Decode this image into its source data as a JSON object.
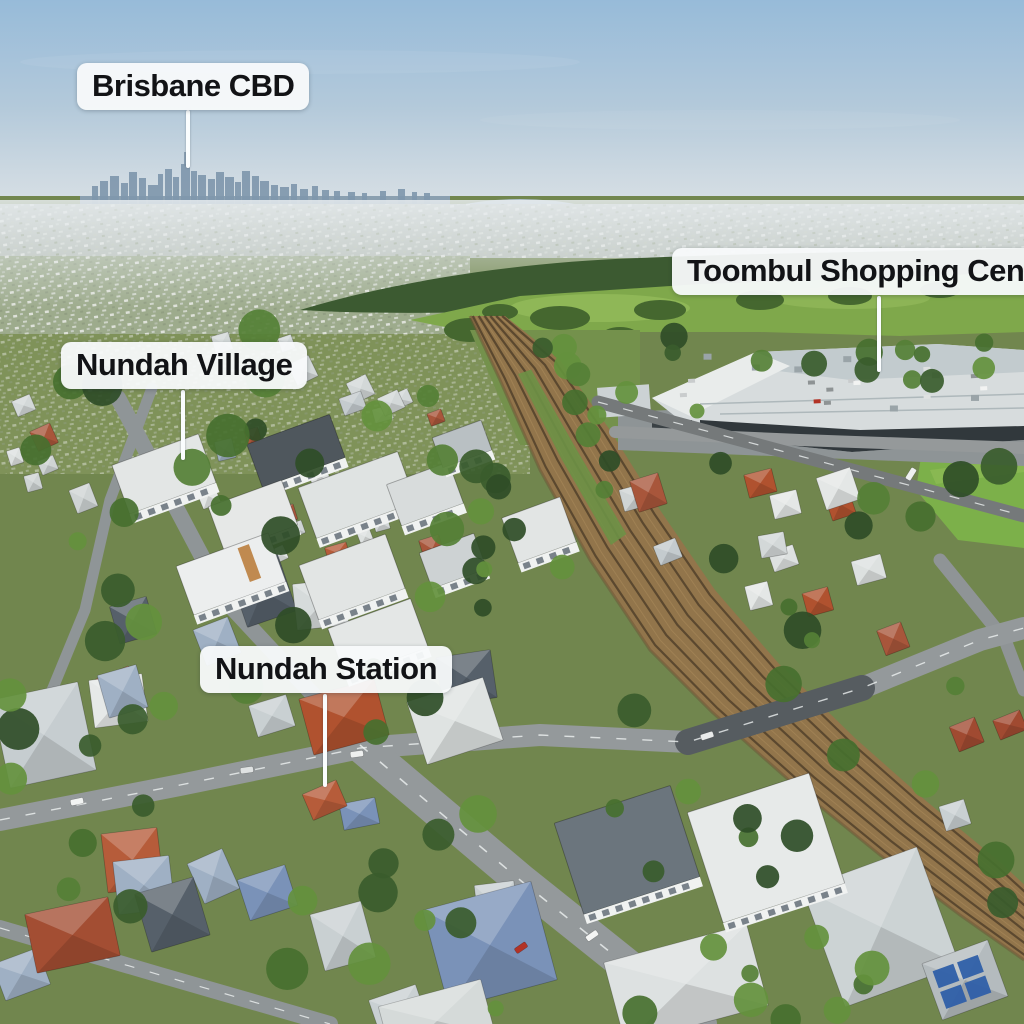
{
  "image_type": "annotated aerial drone photograph of a suburb",
  "location_labels": [
    {
      "text": "Brisbane CBD"
    },
    {
      "text": "Nundah Village"
    },
    {
      "text": "Toombul Shopping Centre",
      "clipped_at_right_edge": true
    },
    {
      "text": "Nundah Station"
    }
  ],
  "colors": {
    "label_background": "#f8fafb",
    "label_text": "#121316",
    "leader_line": "#fafdfe",
    "sky_top": "#97bbd9",
    "sky_horizon": "#d8e0e5",
    "skyline_silhouette": "#7f97ac",
    "forest_band": "#3c5a31",
    "meadow": "#7fa84b",
    "sports_field": "#7cb04a",
    "rail_ballast": "#92754b",
    "road_asphalt": "#94999b",
    "roof_white": "#e3e6e5",
    "roof_terracotta": "#b0522f",
    "roof_blue_grey": "#7a92b8",
    "shopping_centre_roof": "#d7dcdd",
    "shopping_centre_front": "#31383c"
  }
}
